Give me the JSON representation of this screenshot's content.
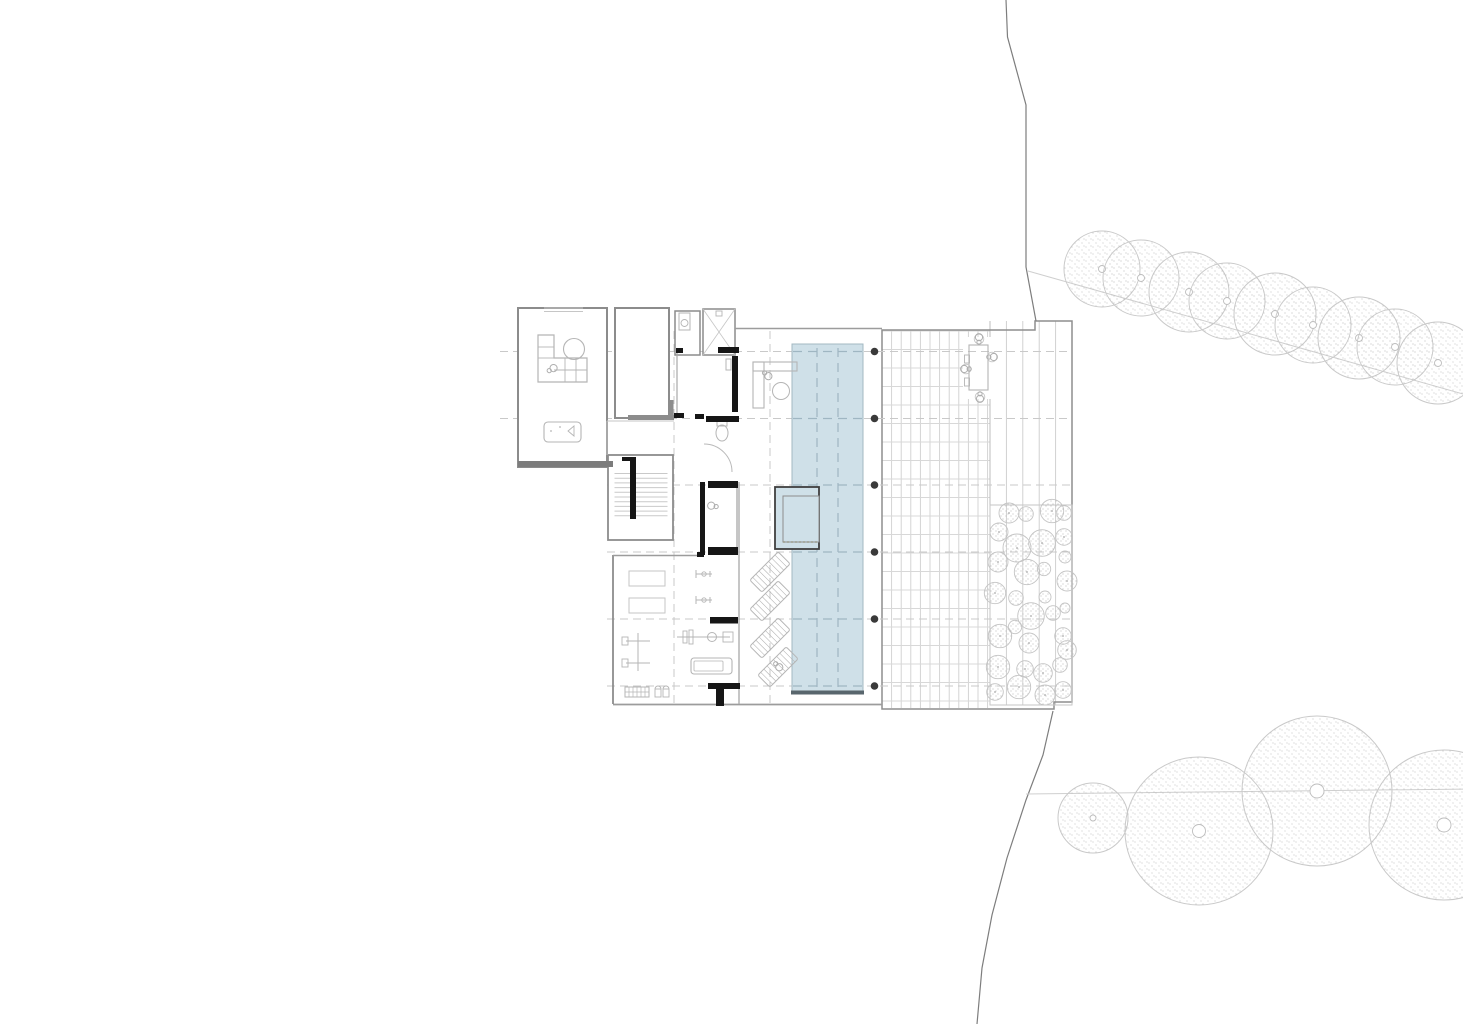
{
  "canvas": {
    "w": 1463,
    "h": 1024,
    "bg": "#ffffff"
  },
  "palette": {
    "wall": "#8c8c8c",
    "wall_med": "#7c7c7c",
    "wall_light": "#9c9c9c",
    "wall_thin": "#a8a8a8",
    "wall_dark": "#161616",
    "furn": "#b5b5b5",
    "furn_light": "#c6c6c6",
    "grid": "#c9c9c9",
    "corridor": "#c4c4c4",
    "deck_line": "#d0d0d0",
    "deck_joint": "#d8d8d8",
    "board_line": "#cdcdcd",
    "deck_edge": "#8e8e8e",
    "pool_fill": "#cfe0e8",
    "pool_edge": "#a3b8c2",
    "pool_dark": "#59666d",
    "lane": "#9fb6c2",
    "spa_edge": "#3f3f3f",
    "spa_inner": "#8c8c8c",
    "spa_dotted": "#9a9a8a",
    "column": "#3a3a3a",
    "person": "#aeaeae",
    "tree_stroke": "#c9c9c9",
    "stipple": "#b9b9b9",
    "shrub_stroke": "#c4c4c4",
    "shrub_stipple": "#ababab",
    "boundary": "#7d7d7d",
    "guide": "#cfcfcf",
    "white": "#ffffff"
  },
  "deck": {
    "outline": "882,330 1035,330 1035,321 1072,321 1072,702 1054,702 1054,709 882,709",
    "grid_region": [
      882,
      331,
      108,
      377
    ],
    "grid_spacing": [
      9.6,
      18.5
    ],
    "board_regions": [
      [
        990,
        321,
        82,
        184
      ],
      [
        990,
        505,
        82,
        200
      ]
    ],
    "board_spacing": 16.4,
    "divider": [
      990,
      321,
      990,
      705
    ],
    "shrub_bed": [
      990,
      505,
      82,
      200
    ],
    "dining_clear": [
      963,
      337,
      28,
      62
    ]
  },
  "gridlines": {
    "h": [
      {
        "y": 351.5,
        "x1": 500
      },
      {
        "y": 418.5,
        "x1": 500
      },
      {
        "y": 485,
        "x1": 607
      },
      {
        "y": 552,
        "x1": 607
      },
      {
        "y": 619,
        "x1": 607
      },
      {
        "y": 686,
        "x1": 607
      }
    ],
    "x2": 1072,
    "v": [
      {
        "x": 674,
        "y1": 331,
        "y2": 704
      },
      {
        "x": 770,
        "y1": 331,
        "y2": 704
      }
    ]
  },
  "pool": {
    "rect": [
      792,
      344,
      71,
      349
    ],
    "lanes_x": [
      817,
      838
    ],
    "lane_y1": 348,
    "lane_y2": 690,
    "cross_y": [
      351.5,
      418.5,
      485,
      552,
      619,
      686
    ],
    "bottom_edge": [
      791,
      692.5,
      864,
      692.5
    ]
  },
  "spa": {
    "outer": [
      775,
      487,
      44,
      62
    ],
    "inner": [
      783,
      496,
      36,
      46
    ]
  },
  "columns": {
    "x": 874.5,
    "ys": [
      351.5,
      418.5,
      485,
      552,
      619,
      686
    ],
    "r": 3.8
  },
  "rooms": [
    {
      "name": "lounge-room",
      "rect": [
        518,
        308,
        89,
        159
      ],
      "sw": 2
    },
    {
      "name": "storage-room",
      "rect": [
        615,
        308,
        54,
        110
      ],
      "sw": 2
    },
    {
      "name": "bathroom",
      "rect": [
        675,
        311,
        25,
        44
      ],
      "sw": 1.5
    },
    {
      "name": "shower-room",
      "rect": [
        703,
        309,
        32,
        46
      ],
      "sw": 1.5
    },
    {
      "name": "stairwell",
      "rect": [
        608,
        455,
        65,
        85
      ],
      "sw": 1.8
    }
  ],
  "wall_lines": [
    [
      628,
      417.5,
      674,
      417.5,
      5,
      "wall"
    ],
    [
      671.5,
      400,
      671.5,
      419,
      4,
      "wall"
    ],
    [
      518,
      464,
      613,
      464,
      6,
      "wall_med"
    ],
    [
      735,
      328.5,
      882,
      328.5,
      1.5,
      "wall_light"
    ],
    [
      613,
      704.5,
      882,
      704.5,
      1.8,
      "wall_light"
    ],
    [
      613,
      555,
      613,
      704,
      1.8,
      "wall"
    ],
    [
      613,
      555.5,
      703,
      555.5,
      1.5,
      "wall_light"
    ],
    [
      677,
      351,
      677,
      415,
      1.2,
      "wall_thin"
    ],
    [
      737,
      482,
      737,
      555,
      1.3,
      "wall_thin"
    ],
    [
      739,
      482,
      739,
      704,
      1.3,
      "wall_thin"
    ],
    [
      607,
      421,
      674,
      421,
      1,
      "corridor"
    ],
    [
      607,
      421,
      607,
      455,
      1,
      "corridor"
    ],
    [
      544,
      308,
      583,
      308,
      1,
      "furn_light"
    ],
    [
      544,
      311.5,
      583,
      311.5,
      1,
      "furn_light"
    ]
  ],
  "dark_bars": [
    [
      718,
      347,
      21,
      6
    ],
    [
      676,
      348,
      7,
      5
    ],
    [
      732,
      356,
      6,
      56
    ],
    [
      674,
      413,
      10,
      5
    ],
    [
      695,
      414,
      9,
      5
    ],
    [
      706,
      416,
      33,
      6
    ],
    [
      700,
      482,
      5,
      73
    ],
    [
      708,
      481,
      30,
      7
    ],
    [
      708,
      547,
      30,
      8
    ],
    [
      697,
      552,
      7,
      5
    ],
    [
      710,
      617,
      28,
      6.5
    ],
    [
      708,
      683,
      32,
      6
    ],
    [
      716,
      689,
      8,
      17
    ],
    [
      630,
      457,
      6,
      62
    ],
    [
      622,
      457,
      14,
      4
    ]
  ],
  "stairs": {
    "treads_x1": 614.5,
    "treads_x2": 667.5,
    "tread_y0": 473.5,
    "tread_step": 4.7,
    "tread_count": 10
  },
  "door_arc": "M 704 444 A 28 28 0 0 1 732 472",
  "furniture": {
    "sofa_path": "M 538 335 h 16 v 23 h 33 v 24 h -49 Z",
    "sofa_lines": [
      [
        538,
        347,
        554,
        347
      ],
      [
        538,
        358,
        554,
        358
      ],
      [
        554,
        370,
        587,
        370
      ],
      [
        565,
        358,
        565,
        382
      ],
      [
        576,
        358,
        576,
        382
      ]
    ],
    "round_table": [
      574,
      349,
      10.5
    ],
    "pool_table": {
      "rect": [
        544,
        422,
        37,
        20
      ],
      "tri": "M 574 426 L 568 431 L 574 436 Z",
      "dots": [
        [
          551,
          431
        ],
        [
          560,
          427
        ]
      ]
    },
    "sink": {
      "rect": [
        679,
        313,
        11,
        17
      ],
      "bowl": [
        684.5,
        323,
        3.5
      ]
    },
    "shower_x": [
      703,
      309,
      32,
      46
    ],
    "shower_drain": [
      716,
      311,
      6,
      5
    ],
    "toilet": {
      "bowl": [
        722,
        433,
        6,
        8
      ],
      "tank": [
        717,
        421,
        10,
        5
      ]
    },
    "wall_item": [
      726,
      359,
      5,
      11
    ],
    "desk": {
      "top": [
        753,
        362,
        44,
        9
      ],
      "side": [
        753,
        362,
        11,
        46
      ],
      "chair": [
        781,
        391,
        8.5
      ]
    },
    "mats": [
      [
        629,
        571,
        36,
        15
      ],
      [
        629,
        598,
        36,
        15
      ]
    ],
    "cable_machine": {
      "v": [
        638,
        633,
        638,
        671
      ],
      "h": [
        [
          626,
          641,
          650,
          641
        ],
        [
          626,
          663,
          650,
          663
        ]
      ],
      "boxes": [
        [
          622,
          637,
          6,
          8
        ],
        [
          622,
          659,
          6,
          8
        ]
      ]
    },
    "bench_press": {
      "bar": [
        677,
        637,
        730,
        637
      ],
      "plates": [
        [
          683,
          631,
          4,
          12
        ],
        [
          689,
          630,
          4,
          14
        ]
      ],
      "seat": [
        712,
        637,
        4.5
      ],
      "rack": [
        723,
        632,
        10,
        10
      ]
    },
    "treadmill": {
      "outer": [
        691,
        658,
        41,
        16
      ],
      "inner": [
        694,
        661,
        29,
        10
      ]
    },
    "dumbbell_rack": [
      625,
      687,
      24,
      10
    ],
    "kettlebells": [
      [
        655,
        689,
        6,
        8
      ],
      [
        663,
        689,
        6,
        8
      ]
    ],
    "bikes": [
      [
        704,
        574
      ],
      [
        704,
        600
      ]
    ],
    "loungers": [
      [
        770,
        572,
        -45
      ],
      [
        770,
        601,
        -45
      ],
      [
        770,
        638,
        -45
      ],
      [
        778,
        667,
        -45
      ]
    ],
    "dining_table": [
      969,
      345,
      19,
      45
    ],
    "dining_side_rects": [
      [
        964.5,
        355,
        5,
        8
      ],
      [
        964.5,
        378,
        5,
        8
      ]
    ],
    "dining_chairs": [
      [
        979,
        339
      ],
      [
        992,
        357
      ],
      [
        966,
        369
      ],
      [
        980,
        397
      ]
    ]
  },
  "persons": [
    [
      552,
      369,
      -120
    ],
    [
      767,
      375,
      -50
    ],
    [
      713,
      506,
      100
    ],
    [
      778,
      666,
      -45
    ],
    [
      979,
      339,
      180
    ],
    [
      992,
      357,
      -90
    ],
    [
      966,
      369,
      90
    ],
    [
      980,
      397,
      0
    ]
  ],
  "site": {
    "boundary_upper": "1006,0 1007.5,37 1026,105 1026,267 1036,321",
    "boundary_lower": "1053,711 1043,755 1026,800 1007,858 992,915 982,968 977,1024",
    "guide_upper": [
      1028,
      271,
      1470,
      396
    ],
    "guide_lower": [
      1026,
      794,
      1470,
      789
    ],
    "trees_upper": [
      [
        1102,
        269,
        38
      ],
      [
        1141,
        278,
        38
      ],
      [
        1189,
        292,
        40
      ],
      [
        1227,
        301,
        38
      ],
      [
        1275,
        314,
        41
      ],
      [
        1313,
        325,
        38
      ],
      [
        1359,
        338,
        41
      ],
      [
        1395,
        347,
        38
      ],
      [
        1438,
        363,
        41
      ]
    ],
    "trees_lower": [
      [
        1093,
        818,
        35,
        3
      ],
      [
        1199,
        831,
        74,
        6.5
      ],
      [
        1317,
        791,
        75,
        7
      ],
      [
        1444,
        825,
        75,
        7
      ]
    ],
    "upper_ring_r": 3.5
  },
  "shrubs": [
    [
      1009,
      513,
      10
    ],
    [
      1026,
      514,
      7.3
    ],
    [
      1052,
      511,
      11.7
    ],
    [
      1064,
      513,
      7.3
    ],
    [
      999,
      532,
      9
    ],
    [
      1017,
      548,
      14
    ],
    [
      1042,
      543,
      13.3
    ],
    [
      1064,
      537,
      8.3
    ],
    [
      998,
      562,
      10
    ],
    [
      1065,
      557,
      6
    ],
    [
      1027,
      572,
      12.7
    ],
    [
      1044,
      569,
      6.7
    ],
    [
      1067,
      581,
      10
    ],
    [
      995,
      593,
      10.7
    ],
    [
      1016,
      598,
      7.3
    ],
    [
      1045,
      597,
      6
    ],
    [
      1031,
      616,
      13.3
    ],
    [
      1053,
      613,
      7.3
    ],
    [
      1065,
      608,
      5
    ],
    [
      1000,
      636,
      11.7
    ],
    [
      1015,
      627,
      6.7
    ],
    [
      1063,
      636,
      8.3
    ],
    [
      1029,
      643,
      10
    ],
    [
      1067,
      650,
      9.3
    ],
    [
      998,
      667,
      11.7
    ],
    [
      1025,
      669,
      8.3
    ],
    [
      1043,
      673,
      9.3
    ],
    [
      1060,
      665,
      7.3
    ],
    [
      995,
      692,
      8.3
    ],
    [
      1019,
      687,
      11.7
    ],
    [
      1045,
      695,
      10
    ],
    [
      1063,
      690,
      8.3
    ]
  ]
}
